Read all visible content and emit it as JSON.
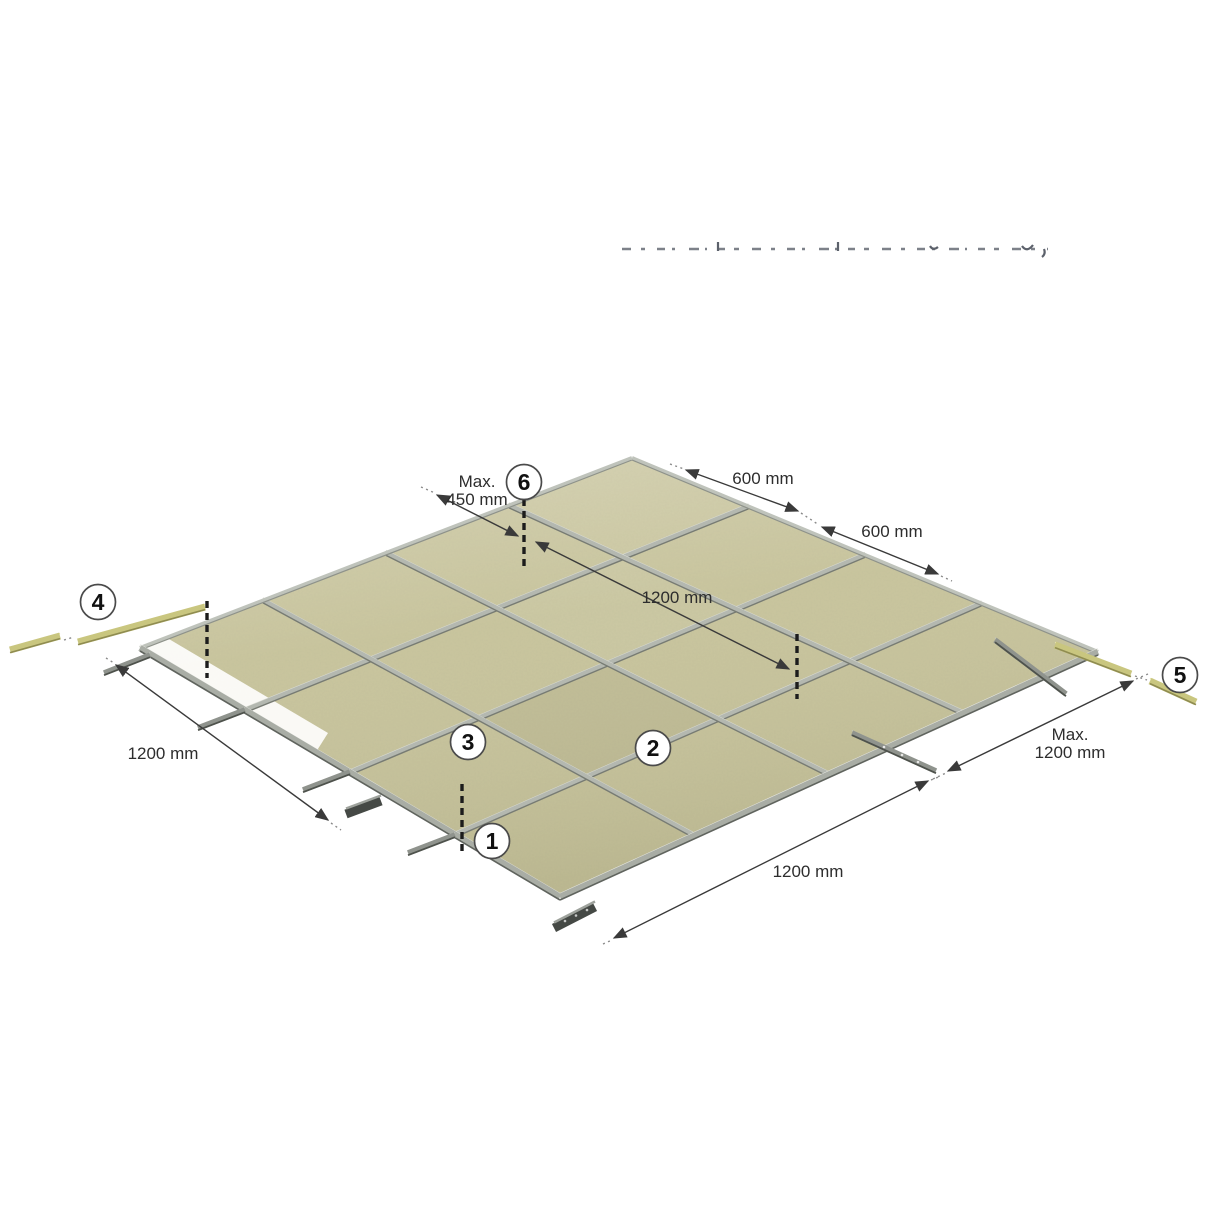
{
  "diagram": {
    "title_hidden": "",
    "dimensions": {
      "max_450": {
        "line1": "Max.",
        "line2": "450 mm"
      },
      "top_600_first": "600 mm",
      "top_600_second": "600 mm",
      "diagonal_1200": "1200 mm",
      "left_1200": "1200 mm",
      "bottom_1200": "1200 mm",
      "max_1200": {
        "line1": "Max.",
        "line2": "1200 mm"
      }
    },
    "callouts": [
      {
        "label": "1"
      },
      {
        "label": "2"
      },
      {
        "label": "3"
      },
      {
        "label": "4"
      },
      {
        "label": "5"
      },
      {
        "label": "6"
      }
    ],
    "colors": {
      "panel": "#c8c49b",
      "rail": "#b4b8b0",
      "rail_dark": "#777b73",
      "wall_angle": "#c9c67f",
      "dimension_text": "#2d2d2d"
    }
  }
}
